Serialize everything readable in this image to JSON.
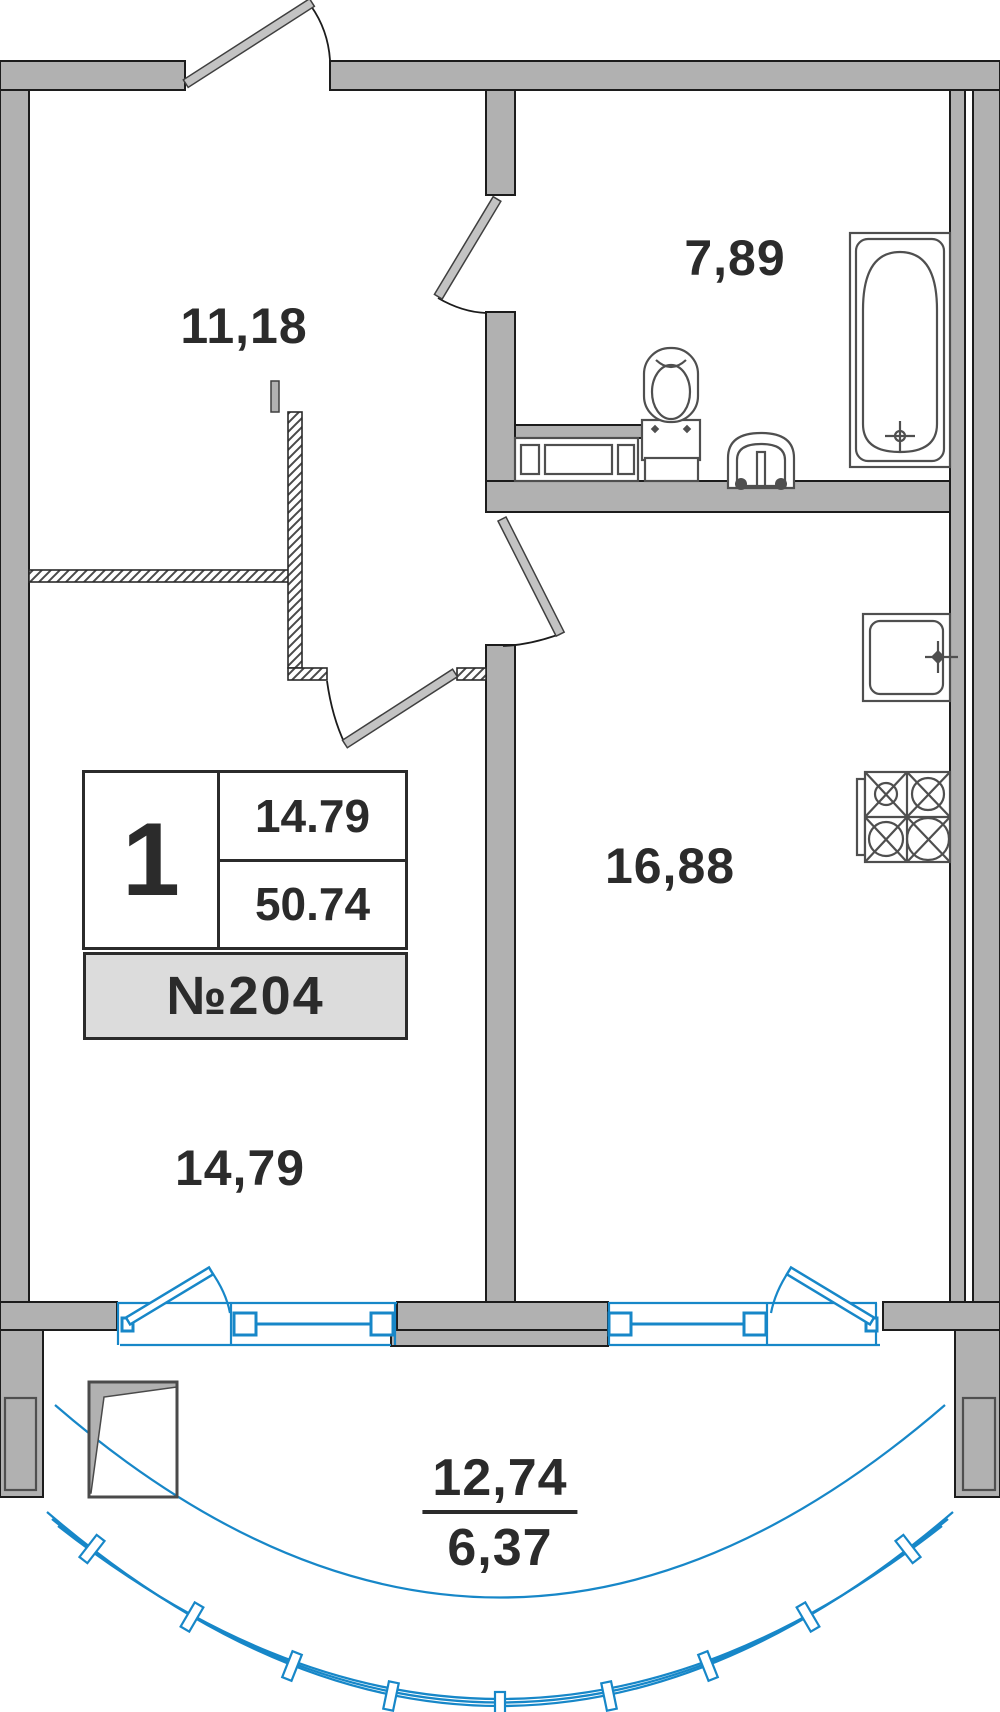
{
  "rooms": {
    "hallway": {
      "area": "11,18"
    },
    "bathroom": {
      "area": "7,89"
    },
    "kitchen": {
      "area": "16,88"
    },
    "living_room": {
      "area": "14,79"
    },
    "balcony": {
      "area_total": "12,74",
      "area_coef": "6,37"
    }
  },
  "info_box": {
    "rooms_count": "1",
    "living_area": "14.79",
    "total_area": "50.74",
    "apartment_number": "№204"
  },
  "colors": {
    "wall_fill": "#b1b1b1",
    "wall_outline": "#1c1c1c",
    "fixture_stroke": "#4f4f4f",
    "window_blue": "#1787c8",
    "text": "#2b2b2b",
    "info_bar_bg": "#dcdcdc"
  }
}
